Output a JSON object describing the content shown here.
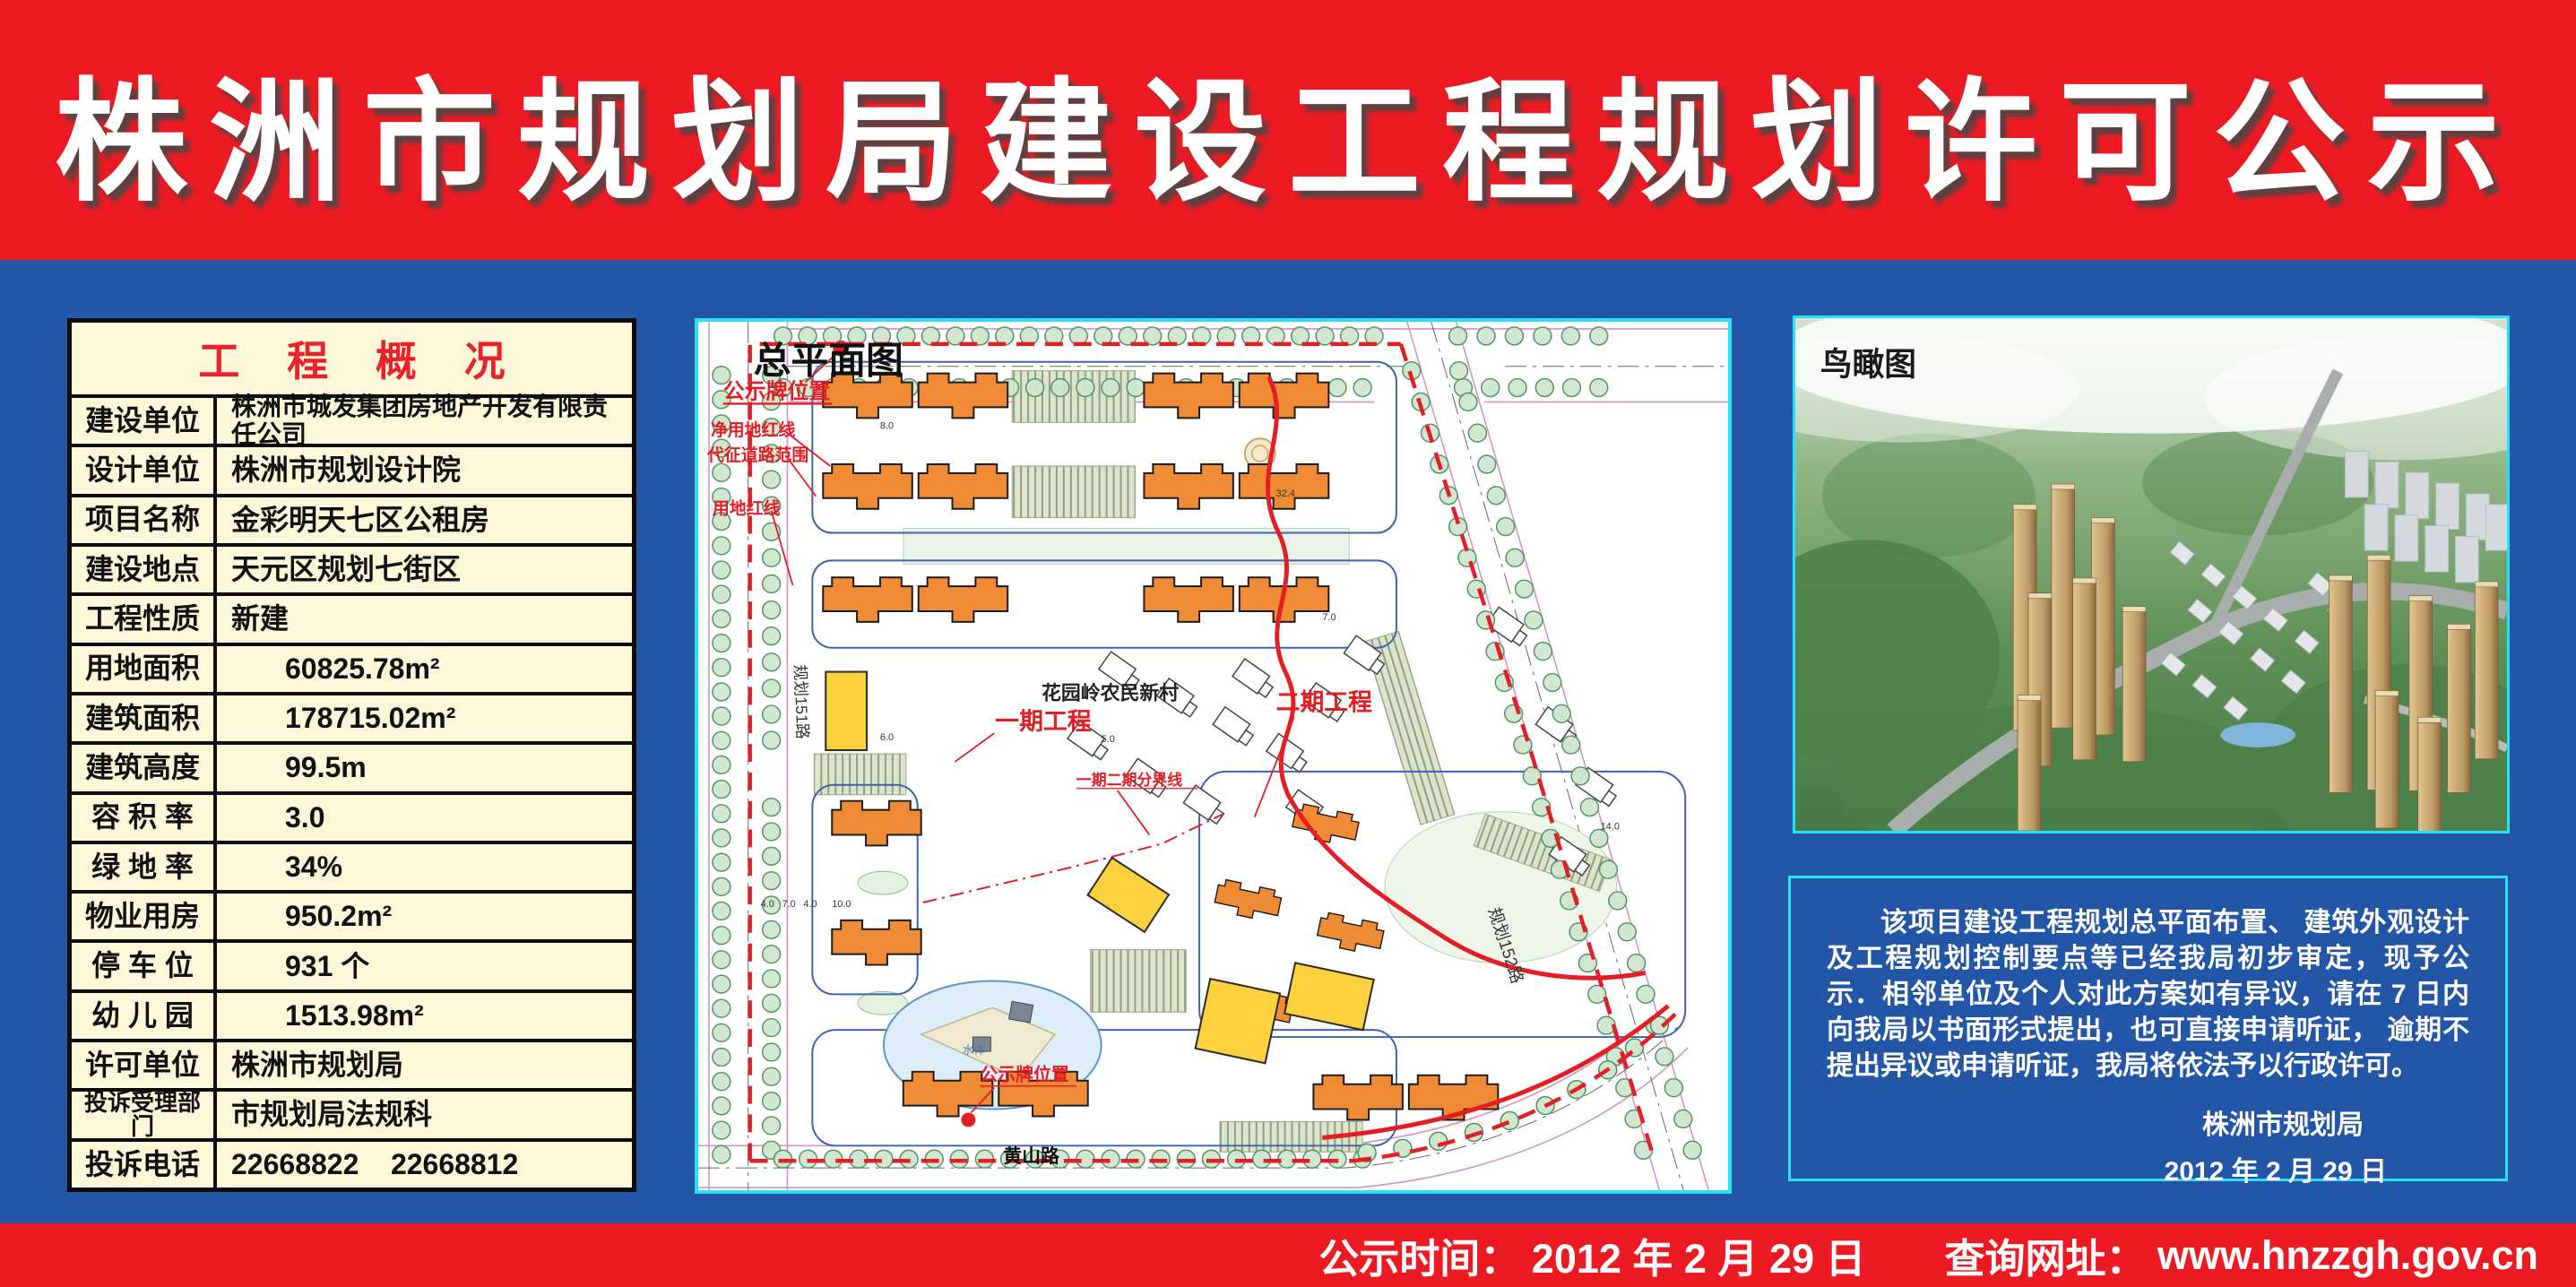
{
  "header": {
    "title": "株洲市规划局建设工程规划许可公示"
  },
  "project_table": {
    "title": "工 程 概 况",
    "rows": [
      {
        "label": "建设单位",
        "value": "株洲市城发集团房地产开发有限责任公司"
      },
      {
        "label": "设计单位",
        "value": "株洲市规划设计院"
      },
      {
        "label": "项目名称",
        "value": "金彩明天七区公租房"
      },
      {
        "label": "建设地点",
        "value": "天元区规划七街区"
      },
      {
        "label": "工程性质",
        "value": "新建"
      },
      {
        "label": "用地面积",
        "value": "60825.78m²"
      },
      {
        "label": "建筑面积",
        "value": "178715.02m²"
      },
      {
        "label": "建筑高度",
        "value": "99.5m"
      },
      {
        "label": "容 积 率",
        "value": "3.0"
      },
      {
        "label": "绿 地 率",
        "value": "34%"
      },
      {
        "label": "物业用房",
        "value": "950.2m²"
      },
      {
        "label": "停 车 位",
        "value": "931 个"
      },
      {
        "label": "幼 儿 园",
        "value": "1513.98m²"
      },
      {
        "label": "许可单位",
        "value": "株洲市规划局"
      },
      {
        "label": "投诉受理部门",
        "value": "市规划局法规科"
      },
      {
        "label": "投诉电话",
        "value": "22668822    22668812"
      }
    ]
  },
  "site_plan": {
    "title": "总平面图",
    "labels": {
      "notice_board_top": "公示牌位置",
      "net_land_red_line": "净用地红线",
      "expropriated_road_range": "代征道路范围",
      "land_red_line": "用地红线",
      "village": "花园岭农民新村",
      "phase1": "一期工程",
      "phase2": "二期工程",
      "phase_divider": "一期二期分界线",
      "road_151": "规划151路",
      "road_152": "规划152路",
      "huangshan_road": "黄山路",
      "notice_board_bottom": "公示牌位置",
      "water": "水体"
    },
    "dimension_labels": [
      "4.0",
      "7.0",
      "4.0",
      "10.0",
      "8.0",
      "6.0",
      "32.4",
      "5.0",
      "7.0",
      "14.0"
    ]
  },
  "aerial": {
    "title": "鸟瞰图"
  },
  "notice": {
    "paragraph": "该项目建设工程规划总平面布置、 建筑外观设计及工程规划控制要点等已经我局初步审定，现予公示．相邻单位及个人对此方案如有异议，请在 7 日内向我局以书面形式提出，也可直接申请听证， 逾期不提出异议或申请听证，我局将依法予以行政许可。",
    "signature": "株洲市规划局",
    "date": "2012 年 2 月 29 日"
  },
  "footer": {
    "time_label": "公示时间： ",
    "time_value": "2012 年 2 月 29 日",
    "url_label": "查询网址： ",
    "url_value": "www.hnzzgh.gov.cn"
  },
  "colors": {
    "banner_red": "#ec1b23",
    "board_blue": "#2356a6",
    "table_cream": "#fbf7d8",
    "panel_border_cyan": "#27e2f6",
    "plan_marking_red": "#e31e25",
    "building_orange": "#ef8b35",
    "building_yellow": "#fdd13d",
    "table_title_red": "#e8232b"
  }
}
